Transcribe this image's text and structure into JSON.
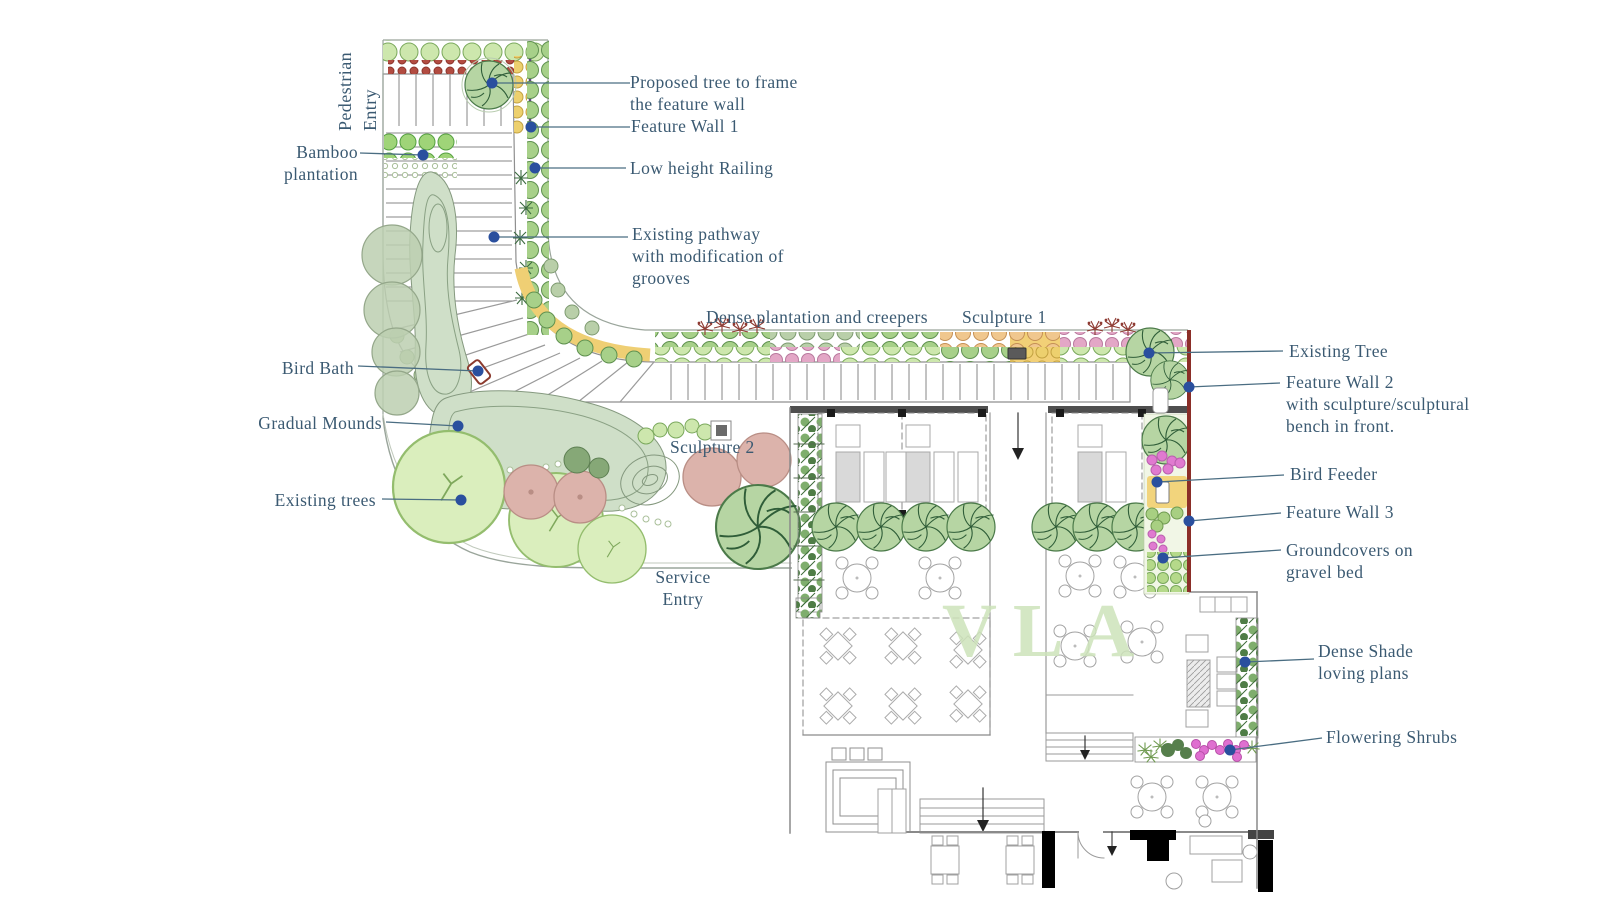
{
  "watermark": {
    "text": "VLA"
  },
  "colors": {
    "label_text": "#3b5a72",
    "leader_line": "#4a6d82",
    "leader_dot": "#2a4f9e",
    "boundary_wall_red": "#8b2e28",
    "watermark_green": "#cde3ba",
    "path_line": "#9a9a9a",
    "shrub_green": "#a7d089",
    "accent_yellow": "#f0d077",
    "accent_pink": "#e07ad0"
  },
  "labels": {
    "pedestrian_entry": {
      "lines": [
        "Pedestrian",
        "Entry"
      ]
    },
    "proposed_tree": {
      "lines": [
        "Proposed tree to frame",
        "the feature wall"
      ]
    },
    "feature_wall_1": {
      "lines": [
        "Feature Wall 1"
      ]
    },
    "bamboo_plantation": {
      "lines": [
        "Bamboo",
        "plantation"
      ]
    },
    "low_height_railing": {
      "lines": [
        "Low height Railing"
      ]
    },
    "existing_pathway": {
      "lines": [
        "Existing pathway",
        "with modification of",
        "grooves"
      ]
    },
    "dense_plantation": {
      "lines": [
        "Dense plantation and creepers"
      ]
    },
    "sculpture_1": {
      "lines": [
        "Sculpture 1"
      ]
    },
    "existing_tree": {
      "lines": [
        "Existing Tree"
      ]
    },
    "feature_wall_2": {
      "lines": [
        "Feature Wall 2",
        "with sculpture/sculptural",
        "bench in front."
      ]
    },
    "bird_bath": {
      "lines": [
        "Bird Bath"
      ]
    },
    "gradual_mounds": {
      "lines": [
        "Gradual Mounds"
      ]
    },
    "sculpture_2": {
      "lines": [
        "Sculpture 2"
      ]
    },
    "bird_feeder": {
      "lines": [
        "Bird Feeder"
      ]
    },
    "feature_wall_3": {
      "lines": [
        "Feature Wall 3"
      ]
    },
    "existing_trees": {
      "lines": [
        "Existing trees"
      ]
    },
    "groundcovers": {
      "lines": [
        "Groundcovers on",
        "gravel bed"
      ]
    },
    "service_entry": {
      "lines": [
        "Service",
        "Entry"
      ]
    },
    "dense_shade": {
      "lines": [
        "Dense Shade",
        "loving plans"
      ]
    },
    "flowering_shrubs": {
      "lines": [
        "Flowering Shrubs"
      ]
    }
  }
}
